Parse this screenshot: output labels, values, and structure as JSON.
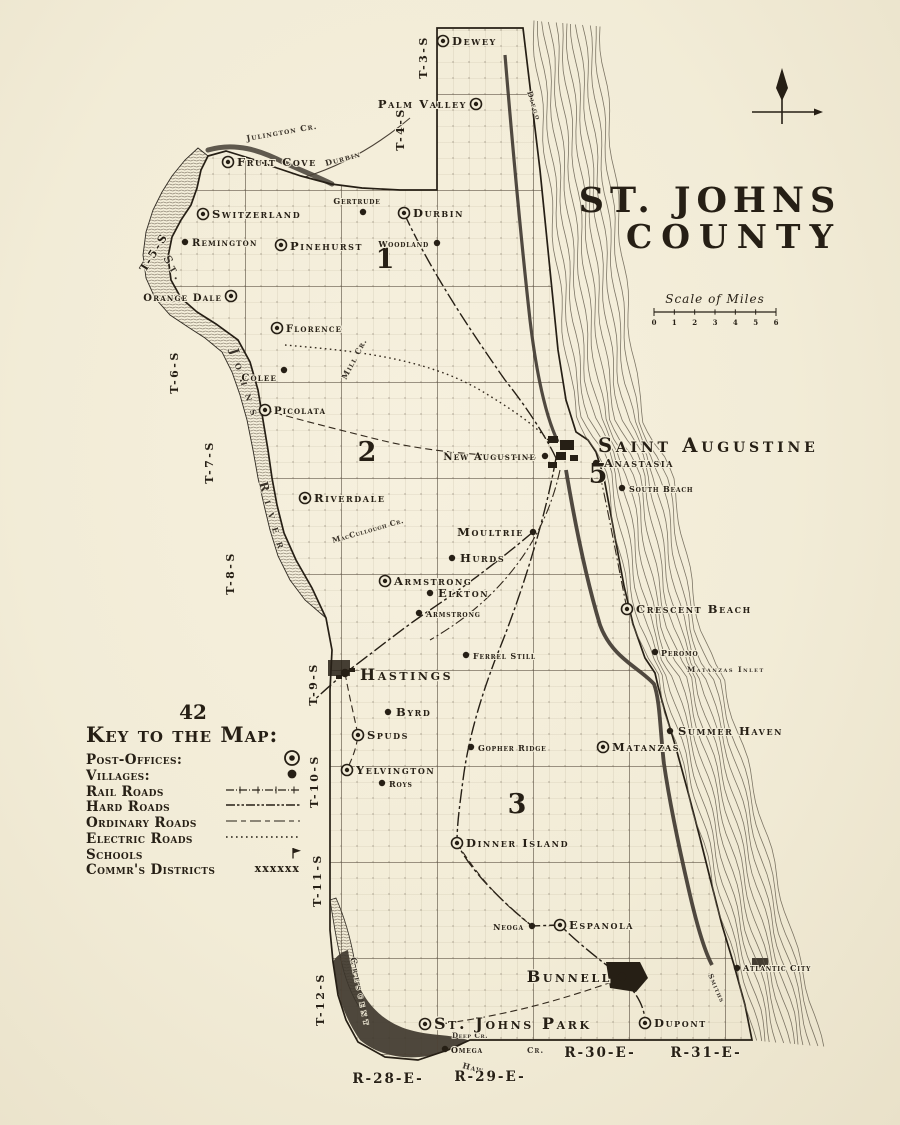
{
  "page_number": "42",
  "title": {
    "line1": "ST. JOHNS",
    "line2": "COUNTY"
  },
  "scale": {
    "label": "Scale of Miles",
    "ticks": [
      "0",
      "1",
      "2",
      "3",
      "4",
      "5",
      "6"
    ]
  },
  "legend": {
    "heading": "Key to the Map:",
    "items": [
      {
        "label": "Post-Offices:",
        "symbol": "post-office"
      },
      {
        "label": "Villages:",
        "symbol": "village"
      },
      {
        "label": "Rail Roads",
        "symbol": "railroad"
      },
      {
        "label": "Hard Roads",
        "symbol": "hard-road"
      },
      {
        "label": "Ordinary Roads",
        "symbol": "ordinary-road"
      },
      {
        "label": "Electric Roads",
        "symbol": "electric-road"
      },
      {
        "label": "Schools",
        "symbol": "school"
      },
      {
        "label": "Commr's Districts",
        "symbol": "district-boundary",
        "symbol_text": "xxxxxx"
      }
    ]
  },
  "map": {
    "townships": [
      {
        "label": "T-3-S",
        "x": 427,
        "y": 57,
        "rot": -90
      },
      {
        "label": "T-4-S",
        "x": 404,
        "y": 129,
        "rot": -90
      },
      {
        "label": "T-5-S",
        "x": 157,
        "y": 254,
        "rot": -58
      },
      {
        "label": "T-6-S",
        "x": 178,
        "y": 372,
        "rot": -90
      },
      {
        "label": "T-7-S",
        "x": 213,
        "y": 462,
        "rot": -90
      },
      {
        "label": "T-8-S",
        "x": 234,
        "y": 573,
        "rot": -90
      },
      {
        "label": "T-9-S",
        "x": 317,
        "y": 684,
        "rot": -90
      },
      {
        "label": "T-10-S",
        "x": 318,
        "y": 781,
        "rot": -90
      },
      {
        "label": "T-11-S",
        "x": 321,
        "y": 880,
        "rot": -90
      },
      {
        "label": "T-12-S",
        "x": 324,
        "y": 999,
        "rot": -90
      }
    ],
    "ranges": [
      {
        "label": "R-28-E-",
        "x": 388,
        "y": 1083
      },
      {
        "label": "R-29-E-",
        "x": 490,
        "y": 1081
      },
      {
        "label": "R-30-E-",
        "x": 600,
        "y": 1057
      },
      {
        "label": "R-31-E-",
        "x": 706,
        "y": 1057
      }
    ],
    "districts": [
      {
        "number": "1",
        "x": 385,
        "y": 268
      },
      {
        "number": "2",
        "x": 367,
        "y": 461
      },
      {
        "number": "5",
        "x": 598,
        "y": 483
      },
      {
        "number": "3",
        "x": 517,
        "y": 813
      }
    ],
    "places": [
      {
        "name": "Dewey",
        "type": "po",
        "x": 443,
        "y": 41,
        "lx": 452,
        "ly": 45,
        "a": "s",
        "s": 3
      },
      {
        "name": "Palm Valley",
        "type": "po",
        "x": 476,
        "y": 104,
        "lx": 467,
        "ly": 108,
        "a": "e",
        "s": 3
      },
      {
        "name": "Fruit Cove",
        "type": "po",
        "x": 228,
        "y": 162,
        "lx": 237,
        "ly": 166,
        "a": "s",
        "s": 3
      },
      {
        "name": "Switzerland",
        "type": "po",
        "x": 203,
        "y": 214,
        "lx": 212,
        "ly": 218,
        "a": "s",
        "s": 3
      },
      {
        "name": "Remington",
        "type": "v",
        "x": 185,
        "y": 242,
        "lx": 192,
        "ly": 246,
        "a": "s",
        "s": 2
      },
      {
        "name": "Pinehurst",
        "type": "po",
        "x": 281,
        "y": 245,
        "lx": 290,
        "ly": 250,
        "a": "s",
        "s": 3
      },
      {
        "name": "Gertrude",
        "type": "v",
        "x": 363,
        "y": 212,
        "lx": 357,
        "ly": 204,
        "a": "m",
        "s": 1
      },
      {
        "name": "Durbin",
        "type": "po",
        "x": 404,
        "y": 213,
        "lx": 413,
        "ly": 217,
        "a": "s",
        "s": 3
      },
      {
        "name": "Woodland",
        "type": "v",
        "x": 437,
        "y": 243,
        "lx": 429,
        "ly": 247,
        "a": "e",
        "s": 1
      },
      {
        "name": "Orange Dale",
        "type": "po",
        "x": 231,
        "y": 296,
        "lx": 222,
        "ly": 301,
        "a": "e",
        "s": 2
      },
      {
        "name": "Florence",
        "type": "po",
        "x": 277,
        "y": 328,
        "lx": 286,
        "ly": 332,
        "a": "s",
        "s": 2
      },
      {
        "name": "Colee",
        "type": "v",
        "x": 284,
        "y": 370,
        "lx": 277,
        "ly": 381,
        "a": "e",
        "s": 2
      },
      {
        "name": "Picolata",
        "type": "po",
        "x": 265,
        "y": 410,
        "lx": 274,
        "ly": 414,
        "a": "s",
        "s": 2
      },
      {
        "name": "Riverdale",
        "type": "po",
        "x": 305,
        "y": 498,
        "lx": 314,
        "ly": 502,
        "a": "s",
        "s": 3
      },
      {
        "name": "New Augustine",
        "type": "v",
        "x": 545,
        "y": 456,
        "lx": 536,
        "ly": 460,
        "a": "e",
        "s": 2
      },
      {
        "name": "Saint Augustine",
        "type": "cl",
        "x": 0,
        "y": 0,
        "lx": 598,
        "ly": 452,
        "a": "s",
        "s": 5
      },
      {
        "name": "Anastasia",
        "type": "v",
        "x": 596,
        "y": 463,
        "lx": 604,
        "ly": 467,
        "a": "s",
        "s": 3
      },
      {
        "name": "South Beach",
        "type": "v",
        "x": 622,
        "y": 488,
        "lx": 629,
        "ly": 492,
        "a": "s",
        "s": 1
      },
      {
        "name": "Moultrie",
        "type": "v",
        "x": 533,
        "y": 532,
        "lx": 524,
        "ly": 536,
        "a": "e",
        "s": 3
      },
      {
        "name": "Hurds",
        "type": "v",
        "x": 452,
        "y": 558,
        "lx": 460,
        "ly": 562,
        "a": "s",
        "s": 3
      },
      {
        "name": "Armstrong",
        "type": "po",
        "x": 385,
        "y": 581,
        "lx": 394,
        "ly": 585,
        "a": "s",
        "s": 3
      },
      {
        "name": "Elkton",
        "type": "v",
        "x": 430,
        "y": 593,
        "lx": 438,
        "ly": 597,
        "a": "s",
        "s": 3
      },
      {
        "name": "Armstrong",
        "type": "v",
        "x": 419,
        "y": 613,
        "lx": 426,
        "ly": 617,
        "a": "s",
        "s": 1
      },
      {
        "name": "Ferrel Still",
        "type": "v",
        "x": 466,
        "y": 655,
        "lx": 473,
        "ly": 659,
        "a": "s",
        "s": 1
      },
      {
        "name": "Hastings",
        "type": "tn",
        "x": 345,
        "y": 673,
        "lx": 360,
        "ly": 680,
        "a": "s",
        "s": 4
      },
      {
        "name": "Byrd",
        "type": "v",
        "x": 388,
        "y": 712,
        "lx": 396,
        "ly": 716,
        "a": "s",
        "s": 3
      },
      {
        "name": "Spuds",
        "type": "po",
        "x": 358,
        "y": 735,
        "lx": 367,
        "ly": 739,
        "a": "s",
        "s": 3
      },
      {
        "name": "Gopher Ridge",
        "type": "v",
        "x": 471,
        "y": 747,
        "lx": 478,
        "ly": 751,
        "a": "s",
        "s": 1
      },
      {
        "name": "Matanzas",
        "type": "po",
        "x": 603,
        "y": 747,
        "lx": 612,
        "ly": 751,
        "a": "s",
        "s": 3
      },
      {
        "name": "Summer Haven",
        "type": "v",
        "x": 670,
        "y": 731,
        "lx": 678,
        "ly": 735,
        "a": "s",
        "s": 3
      },
      {
        "name": "Yelvington",
        "type": "po",
        "x": 347,
        "y": 770,
        "lx": 356,
        "ly": 774,
        "a": "s",
        "s": 3
      },
      {
        "name": "Roys",
        "type": "v",
        "x": 382,
        "y": 783,
        "lx": 389,
        "ly": 787,
        "a": "s",
        "s": 1
      },
      {
        "name": "Crescent Beach",
        "type": "po",
        "x": 627,
        "y": 609,
        "lx": 636,
        "ly": 613,
        "a": "s",
        "s": 3
      },
      {
        "name": "Peromo",
        "type": "v",
        "x": 655,
        "y": 652,
        "lx": 661,
        "ly": 656,
        "a": "s",
        "s": 1
      },
      {
        "name": "Dinner Island",
        "type": "po",
        "x": 457,
        "y": 843,
        "lx": 466,
        "ly": 847,
        "a": "s",
        "s": 3
      },
      {
        "name": "Neoga",
        "type": "v",
        "x": 532,
        "y": 926,
        "lx": 524,
        "ly": 930,
        "a": "e",
        "s": 1
      },
      {
        "name": "Espanola",
        "type": "po",
        "x": 560,
        "y": 925,
        "lx": 569,
        "ly": 929,
        "a": "s",
        "s": 3
      },
      {
        "name": "Bunnell",
        "type": "tn",
        "x": 622,
        "y": 977,
        "lx": 612,
        "ly": 982,
        "a": "e",
        "s": 4
      },
      {
        "name": "St. Johns Park",
        "type": "po",
        "x": 425,
        "y": 1024,
        "lx": 434,
        "ly": 1029,
        "a": "s",
        "s": 4
      },
      {
        "name": "Omega",
        "type": "v",
        "x": 445,
        "y": 1049,
        "lx": 451,
        "ly": 1053,
        "a": "s",
        "s": 1
      },
      {
        "name": "Dupont",
        "type": "po",
        "x": 645,
        "y": 1023,
        "lx": 654,
        "ly": 1027,
        "a": "s",
        "s": 3
      },
      {
        "name": "Atlantic City",
        "type": "v",
        "x": 737,
        "y": 968,
        "lx": 743,
        "ly": 971,
        "a": "s",
        "s": 1
      }
    ],
    "water_labels": [
      {
        "text": "Julington Cr.",
        "x": 247,
        "y": 141,
        "rot": -10,
        "fs": 8,
        "ls": 1
      },
      {
        "text": "Durbin",
        "x": 326,
        "y": 166,
        "rot": -15,
        "fs": 8,
        "ls": 1
      },
      {
        "text": "St.",
        "x": 163,
        "y": 258,
        "rot": 60,
        "fs": 11,
        "ls": 4
      },
      {
        "text": "Johns",
        "x": 230,
        "y": 350,
        "rot": 72,
        "fs": 12,
        "ls": 9
      },
      {
        "text": "River",
        "x": 259,
        "y": 483,
        "rot": 74,
        "fs": 12,
        "ls": 9
      },
      {
        "text": "Mill Cr.",
        "x": 346,
        "y": 380,
        "rot": -62,
        "fs": 8,
        "ls": 1
      },
      {
        "text": "MacCullough Cr.",
        "x": 333,
        "y": 543,
        "rot": -16,
        "fs": 7.5,
        "ls": 0.5
      },
      {
        "text": "Crescent",
        "x": 350,
        "y": 958,
        "rot": 78,
        "fs": 9,
        "ls": 4
      },
      {
        "text": "Haw",
        "x": 462,
        "y": 1068,
        "rot": 14,
        "fs": 8,
        "ls": 1
      },
      {
        "text": "Cr.",
        "x": 527,
        "y": 1053,
        "rot": 0,
        "fs": 8,
        "ls": 1
      },
      {
        "text": "Matanzas Inlet",
        "x": 687,
        "y": 672,
        "rot": 0,
        "fs": 7.5,
        "ls": 1.5
      },
      {
        "text": "Diego",
        "x": 527,
        "y": 92,
        "rot": 72,
        "fs": 7.5,
        "ls": 2
      },
      {
        "text": "Smiths",
        "x": 708,
        "y": 975,
        "rot": 66,
        "fs": 7,
        "ls": 1
      },
      {
        "text": "Deep Cr.",
        "x": 452,
        "y": 1038,
        "rot": 0,
        "fs": 7,
        "ls": 0.5
      }
    ]
  }
}
